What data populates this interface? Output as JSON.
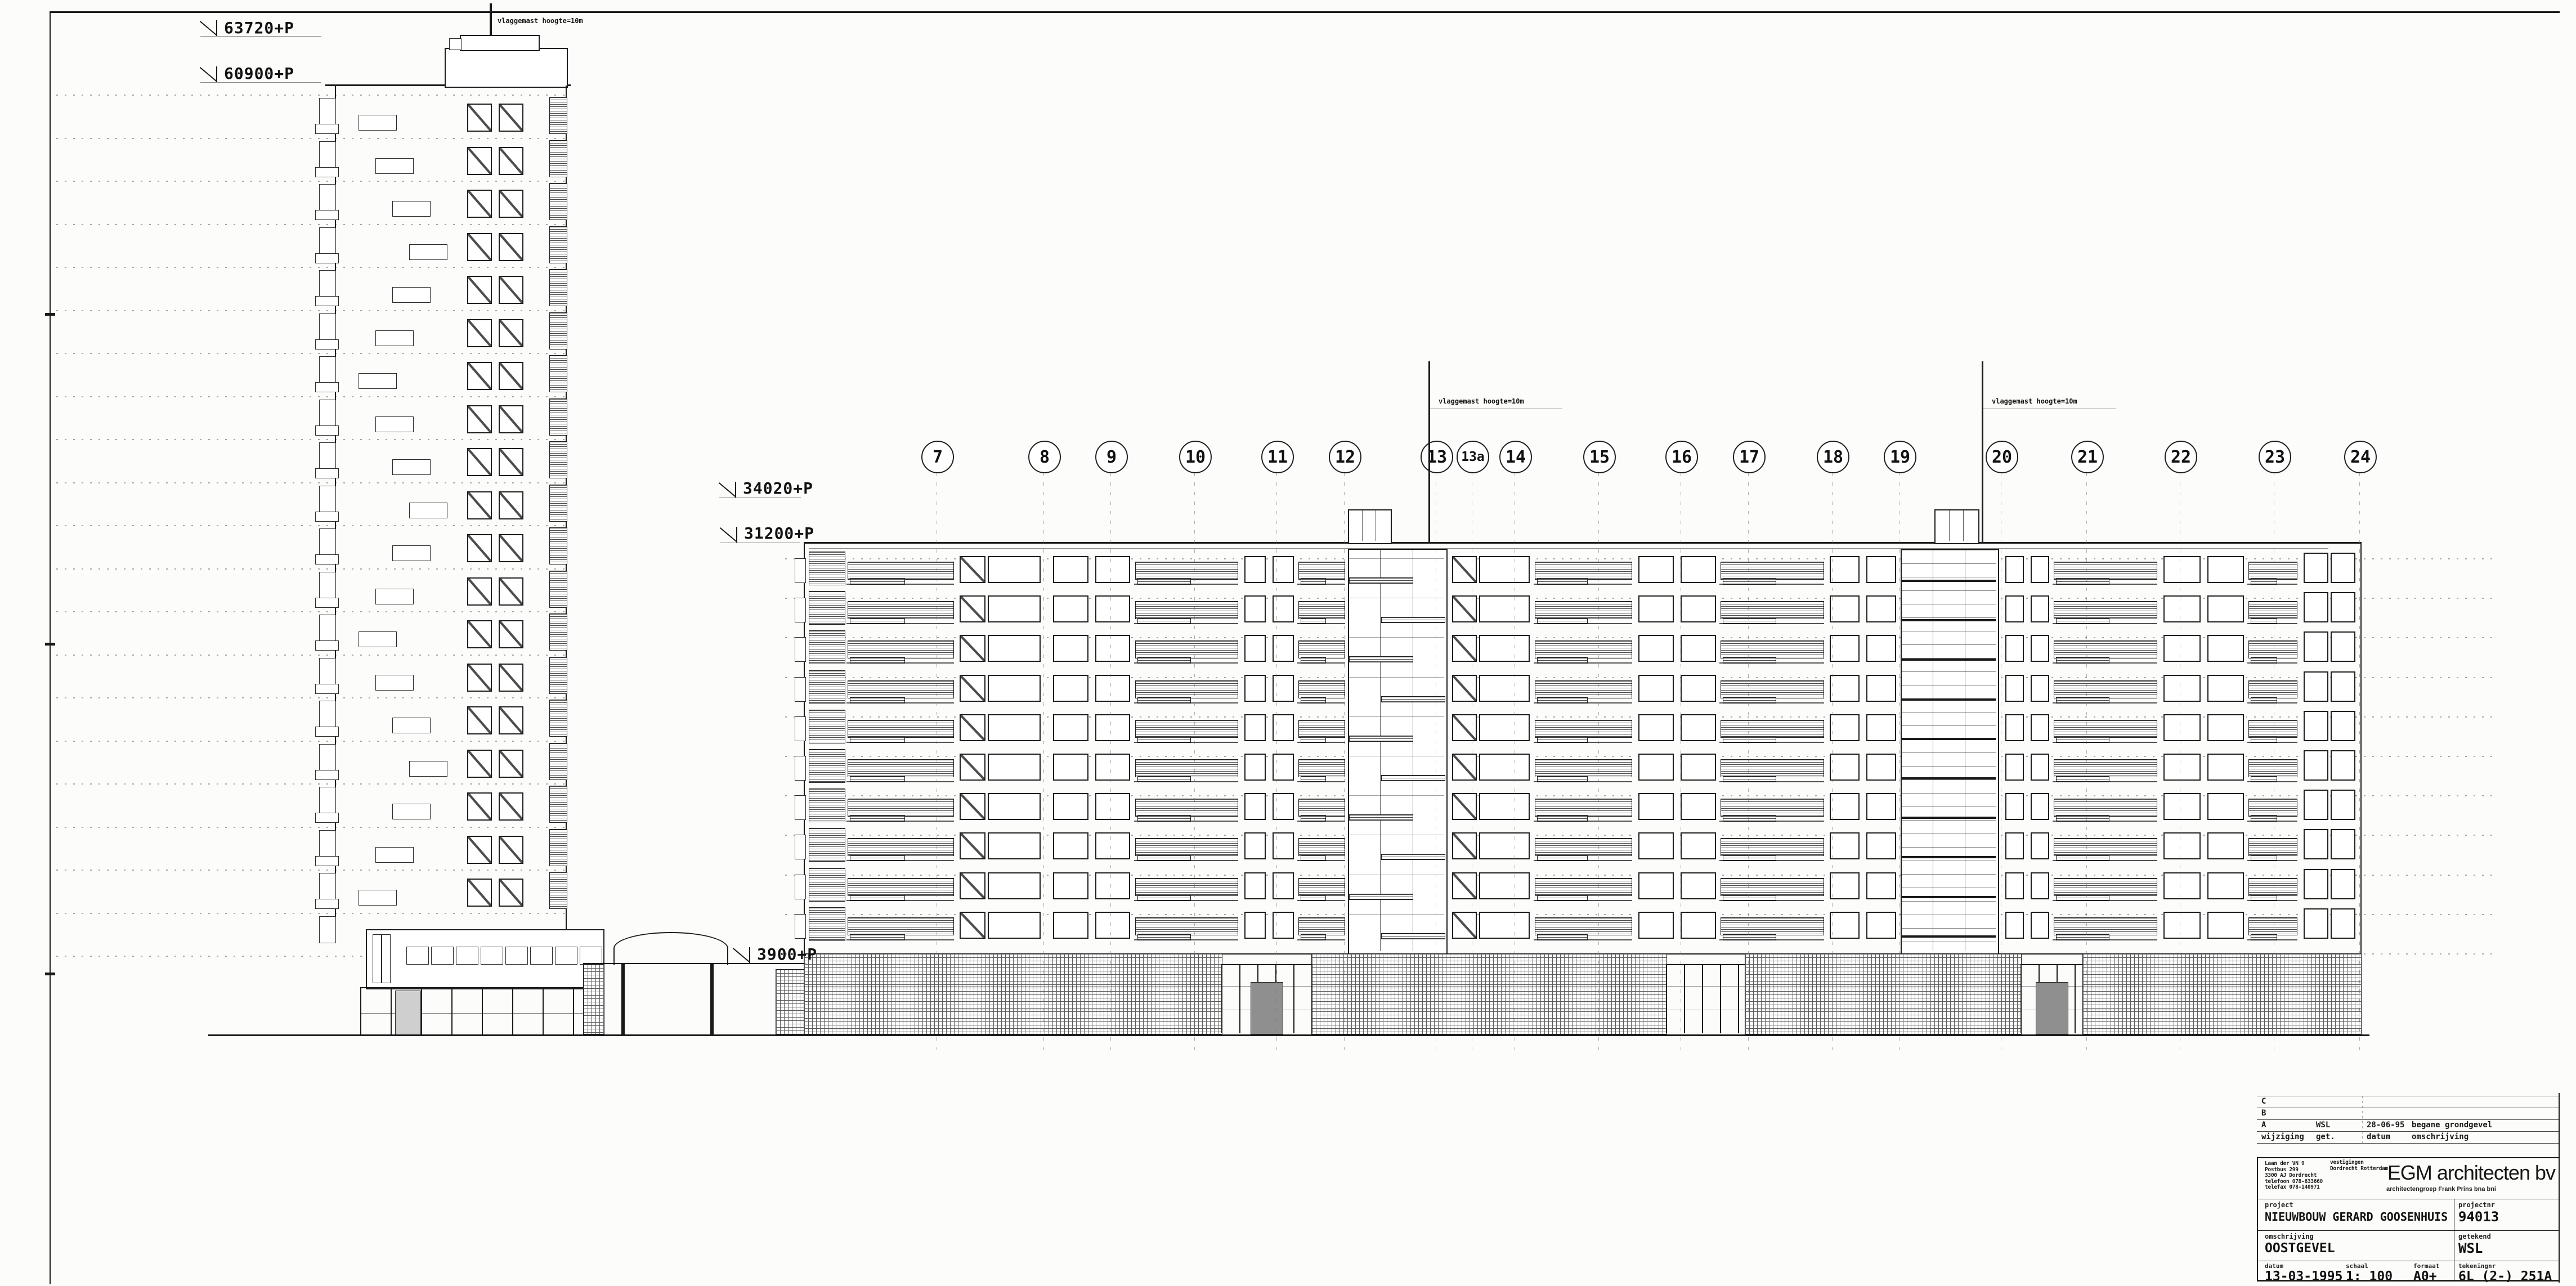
{
  "drawing": {
    "level_markers": [
      "63720+P",
      "60900+P",
      "34020+P",
      "31200+P",
      "3900+P"
    ],
    "flag_note": "vlaggemast hoogte=10m",
    "grid_bubbles": [
      "7",
      "8",
      "9",
      "10",
      "11",
      "12",
      "13",
      "13a",
      "14",
      "15",
      "16",
      "17",
      "18",
      "19",
      "20",
      "21",
      "22",
      "23",
      "24"
    ]
  },
  "title_block": {
    "revisions": {
      "rows": [
        {
          "letter": "C",
          "get": "",
          "datum": "",
          "omschrijving": ""
        },
        {
          "letter": "B",
          "get": "",
          "datum": "",
          "omschrijving": ""
        },
        {
          "letter": "A",
          "get": "WSL",
          "datum": "28-06-95",
          "omschrijving": "begane grondgevel"
        }
      ],
      "header": {
        "wijziging": "wijziging",
        "get": "get.",
        "datum": "datum",
        "omschrijving": "omschrijving"
      }
    },
    "firm": {
      "name": "EGM architecten bv",
      "subtitle": "architectengroep Frank Prins bna bni",
      "address_lines": [
        "Laan der VN 9",
        "Postbus 299",
        "3300 AJ Dordrecht",
        "telefoon 078-633660",
        "telefax 078-140971"
      ],
      "branches_label": "vestigingen",
      "branches": "Dordrecht Rotterdam"
    },
    "fields": {
      "project_label": "project",
      "project": "NIEUWBOUW GERARD GOOSENHUIS",
      "projectnr_label": "projectnr",
      "projectnr": "94013",
      "omschrijving_label": "omschrijving",
      "omschrijving": "OOSTGEVEL",
      "getekend_label": "getekend",
      "getekend": "WSL",
      "datum_label": "datum",
      "datum": "13-03-1995",
      "schaal_label": "schaal",
      "schaal": "1: 100",
      "formaat_label": "formaat",
      "formaat": "A0+",
      "tekeningnr_label": "tekeningnr",
      "tekeningnr": "6L (2-) 251A"
    }
  }
}
